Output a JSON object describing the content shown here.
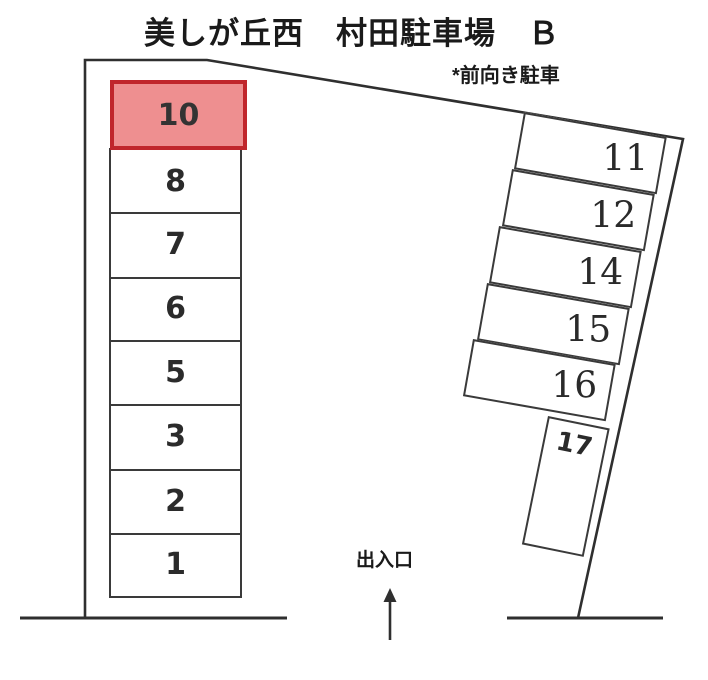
{
  "title": "美しが丘西　村田駐車場　Ｂ",
  "note": "*前向き駐車",
  "entrance": {
    "label": "出入口",
    "arrow_icon": "up-arrow"
  },
  "highlight": {
    "space": "10",
    "fill": "#ee8f90",
    "border": "#c0262c"
  },
  "line_color": "#2f2f2f",
  "spaces": {
    "left": [
      "10",
      "8",
      "7",
      "6",
      "5",
      "3",
      "2",
      "1"
    ],
    "right": [
      "11",
      "12",
      "14",
      "15",
      "16",
      "17"
    ]
  }
}
